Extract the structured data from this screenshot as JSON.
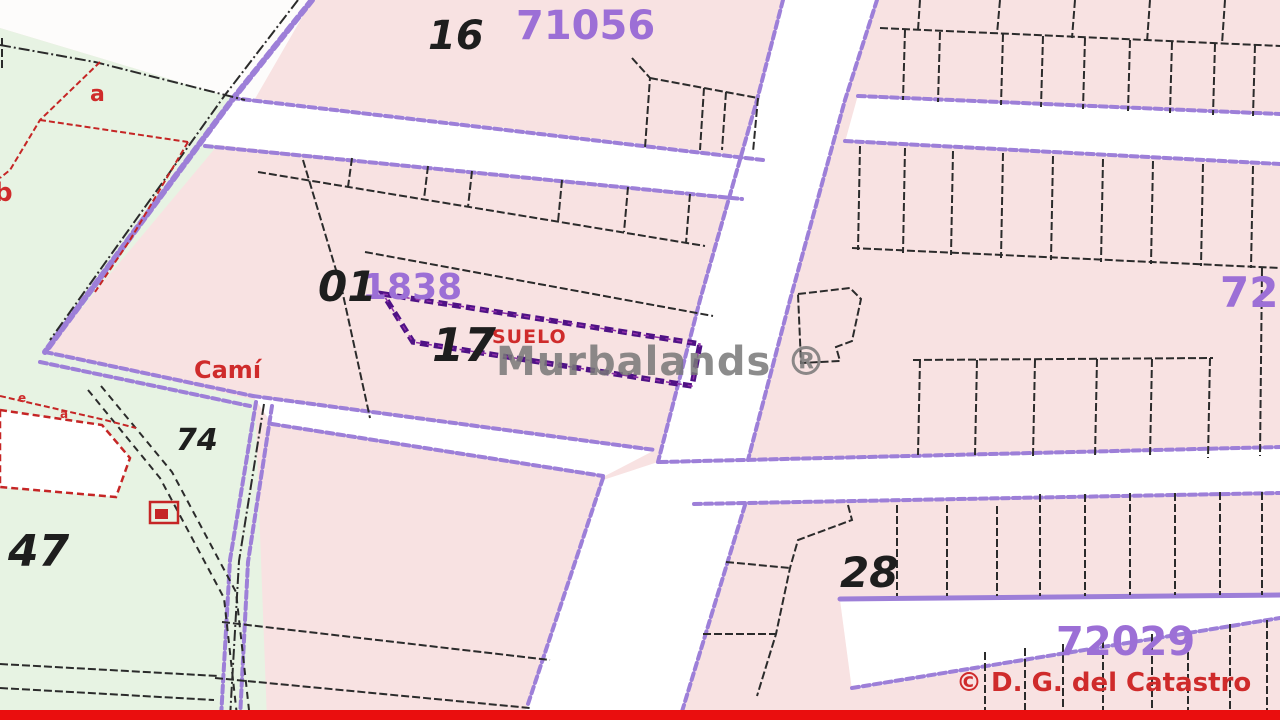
{
  "map_type": "cadastral parcel map",
  "watermark": {
    "text": "Murbalands ®"
  },
  "attribution": {
    "text": "© D. G. del Catastro"
  },
  "labels": {
    "p16": "16",
    "b71056": "71056",
    "p01": "01",
    "n1838": "1838",
    "p17": "17",
    "suelo": "SUELO",
    "cami": "Camí",
    "p74": "74",
    "p47": "47",
    "p28": "28",
    "b72029": "72029",
    "b720_clipped": "720",
    "sub_a": "a",
    "sub_b": "b",
    "tiny_e": "e",
    "tiny_a": "a"
  },
  "colors": {
    "parcel_pink": "#f8e2e2",
    "green_rustic": "#e7f3e3",
    "road_white": "#ffffff",
    "road_edge_purple": "#9d7fd8",
    "parcel_line_black": "#2b2b2b",
    "red_detail": "#c52525",
    "purple_label": "#9c6fd6",
    "selected_parcel_outline": "#4f1285",
    "watermark_gray": "#787878",
    "footer_red": "#ea0e0e"
  }
}
